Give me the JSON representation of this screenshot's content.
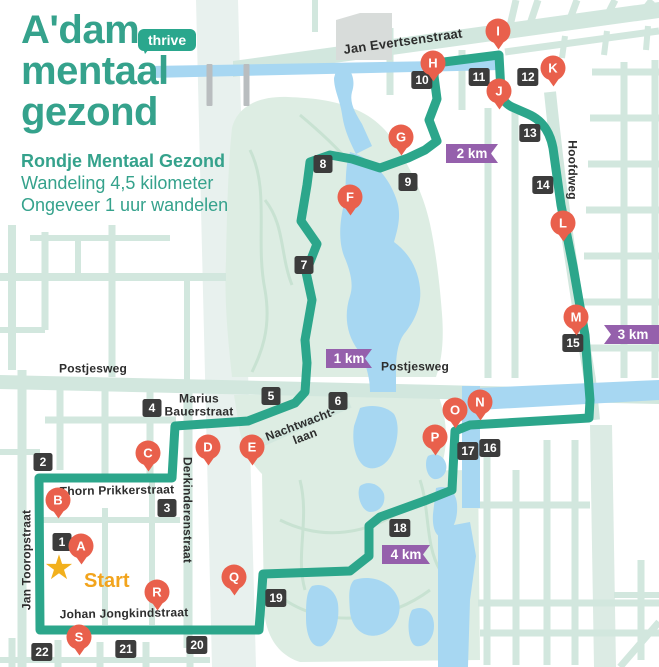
{
  "header": {
    "title_lines": [
      "A'dam",
      "mentaal",
      "gezond"
    ],
    "badge": "thrive",
    "route_name": "Rondje Mentaal Gezond",
    "subtitle_lines": [
      "Wandeling 4,5 kilometer",
      "Ongeveer 1 uur wandelen"
    ]
  },
  "colors": {
    "brand_teal": "#35a28c",
    "route_teal": "#2ca68b",
    "street": "#d2e7de",
    "wide_avenue": "#e8f1ee",
    "park": "#ddede3",
    "park_path": "#c8e2d2",
    "water": "#a7d7f2",
    "pin_red": "#e9604c",
    "waypoint_dark": "#3c3c3c",
    "km_purple": "#9560ac",
    "star_yellow": "#f2b01d",
    "start_orange": "#f2a41d",
    "label_dark": "#2d2d2d"
  },
  "map": {
    "start": {
      "label": "Start",
      "star_x": 59,
      "star_y": 568,
      "text_x": 84,
      "text_y": 570
    },
    "pins": [
      {
        "label": "A",
        "x": 81,
        "y": 546
      },
      {
        "label": "B",
        "x": 58,
        "y": 500
      },
      {
        "label": "C",
        "x": 148,
        "y": 453
      },
      {
        "label": "D",
        "x": 208,
        "y": 447
      },
      {
        "label": "E",
        "x": 252,
        "y": 447
      },
      {
        "label": "F",
        "x": 350,
        "y": 197
      },
      {
        "label": "G",
        "x": 401,
        "y": 137
      },
      {
        "label": "H",
        "x": 433,
        "y": 63
      },
      {
        "label": "I",
        "x": 498,
        "y": 31
      },
      {
        "label": "J",
        "x": 499,
        "y": 91
      },
      {
        "label": "K",
        "x": 553,
        "y": 68
      },
      {
        "label": "L",
        "x": 563,
        "y": 223
      },
      {
        "label": "M",
        "x": 576,
        "y": 317
      },
      {
        "label": "N",
        "x": 480,
        "y": 402
      },
      {
        "label": "O",
        "x": 455,
        "y": 410
      },
      {
        "label": "P",
        "x": 435,
        "y": 437
      },
      {
        "label": "Q",
        "x": 234,
        "y": 577
      },
      {
        "label": "R",
        "x": 157,
        "y": 592
      },
      {
        "label": "S",
        "x": 79,
        "y": 637
      }
    ],
    "waypoints": [
      {
        "label": "1",
        "x": 62,
        "y": 542
      },
      {
        "label": "2",
        "x": 43,
        "y": 462
      },
      {
        "label": "3",
        "x": 167,
        "y": 508
      },
      {
        "label": "4",
        "x": 152,
        "y": 408
      },
      {
        "label": "5",
        "x": 271,
        "y": 396
      },
      {
        "label": "6",
        "x": 338,
        "y": 401
      },
      {
        "label": "7",
        "x": 304,
        "y": 265
      },
      {
        "label": "8",
        "x": 323,
        "y": 164
      },
      {
        "label": "9",
        "x": 408,
        "y": 182
      },
      {
        "label": "10",
        "x": 422,
        "y": 80
      },
      {
        "label": "11",
        "x": 479,
        "y": 77
      },
      {
        "label": "12",
        "x": 528,
        "y": 77
      },
      {
        "label": "13",
        "x": 530,
        "y": 133
      },
      {
        "label": "14",
        "x": 543,
        "y": 185
      },
      {
        "label": "15",
        "x": 573,
        "y": 343
      },
      {
        "label": "16",
        "x": 490,
        "y": 448
      },
      {
        "label": "17",
        "x": 468,
        "y": 451
      },
      {
        "label": "18",
        "x": 400,
        "y": 528
      },
      {
        "label": "19",
        "x": 276,
        "y": 598
      },
      {
        "label": "20",
        "x": 197,
        "y": 645
      },
      {
        "label": "21",
        "x": 126,
        "y": 649
      },
      {
        "label": "22",
        "x": 42,
        "y": 652
      }
    ],
    "km_badges": [
      {
        "id": "1km",
        "label": "1 km",
        "x": 326,
        "y": 349,
        "w": 46,
        "notch": "right"
      },
      {
        "id": "2km",
        "label": "2 km",
        "x": 446,
        "y": 144,
        "w": 52,
        "notch": "right"
      },
      {
        "id": "3km",
        "label": "3 km",
        "x": 604,
        "y": 325,
        "w": 58,
        "notch": "left"
      },
      {
        "id": "4km",
        "label": "4 km",
        "x": 382,
        "y": 545,
        "w": 48,
        "notch": "right"
      }
    ],
    "street_labels": [
      {
        "id": "jan-evertsenstraat",
        "text": "Jan Evertsenstraat",
        "x": 403,
        "y": 42,
        "rot": -8,
        "size": 13
      },
      {
        "id": "hoofdweg",
        "text": "Hoofdweg",
        "x": 572,
        "y": 170,
        "rot": 90,
        "size": 12
      },
      {
        "id": "postjesweg-west",
        "text": "Postjesweg",
        "x": 93,
        "y": 369,
        "rot": 0,
        "size": 12
      },
      {
        "id": "postjesweg-center",
        "text": "Postjesweg",
        "x": 415,
        "y": 367,
        "rot": 0,
        "size": 12
      },
      {
        "id": "marius-bauerstraat",
        "text": "Marius\nBauerstraat",
        "x": 199,
        "y": 406,
        "rot": 0,
        "size": 12
      },
      {
        "id": "derkinderenstraat",
        "text": "Derkinderenstraat",
        "x": 187,
        "y": 510,
        "rot": 90,
        "size": 12
      },
      {
        "id": "nachtwachtlaan",
        "text": "Nachtwacht-\nlaan",
        "x": 303,
        "y": 431,
        "rot": -21,
        "size": 12
      },
      {
        "id": "thorn-prikkerstraat",
        "text": "Thorn Prikkerstraat",
        "x": 117,
        "y": 491,
        "rot": -1,
        "size": 12
      },
      {
        "id": "jan-tooropstraat",
        "text": "Jan Tooropstraat",
        "x": 27,
        "y": 560,
        "rot": -90,
        "size": 12
      },
      {
        "id": "johan-jongkindstraat",
        "text": "Johan Jongkindstraat",
        "x": 124,
        "y": 614,
        "rot": -1,
        "size": 12
      }
    ]
  }
}
